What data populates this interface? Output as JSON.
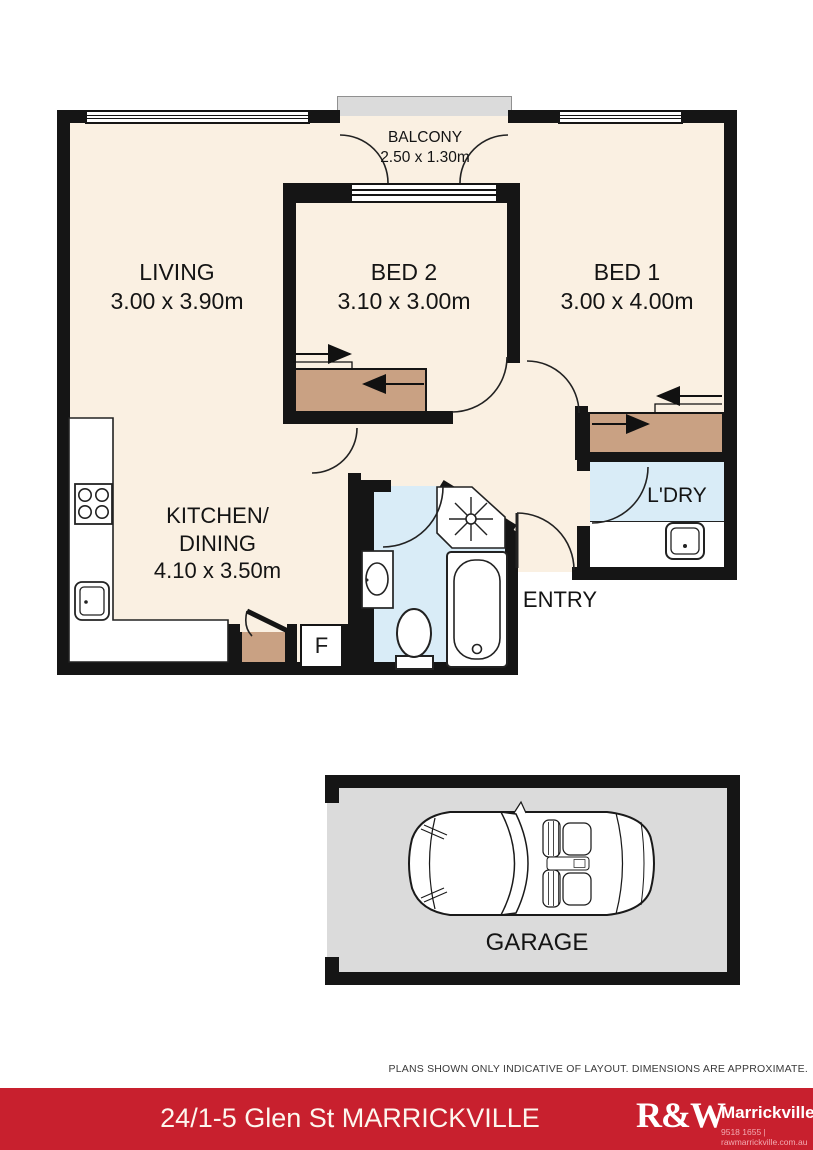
{
  "page": {
    "disclaimer": "PLANS SHOWN ONLY INDICATIVE OF LAYOUT. DIMENSIONS ARE APPROXIMATE.",
    "footer": {
      "address": "24/1-5 Glen St MARRICKVILLE",
      "brand": "R&W",
      "office": "Marrickville",
      "contact": "9518 1655 | rawmarrickville.com.au"
    }
  },
  "rooms": {
    "balcony": {
      "name": "BALCONY",
      "dims": "2.50 x 1.30m"
    },
    "living": {
      "name": "LIVING",
      "dims": "3.00 x 3.90m"
    },
    "bed2": {
      "name": "BED 2",
      "dims": "3.10 x 3.00m"
    },
    "bed1": {
      "name": "BED 1",
      "dims": "3.00 x 4.00m"
    },
    "kitchen": {
      "name_line1": "KITCHEN/",
      "name_line2": "DINING",
      "dims": "4.10 x 3.50m"
    },
    "laundry": {
      "name": "L'DRY"
    },
    "entry": {
      "name": "ENTRY"
    },
    "garage": {
      "name": "GARAGE"
    },
    "fridge": {
      "label": "F"
    }
  },
  "colors": {
    "wall": "#151515",
    "floor_cream": "#FAF0E2",
    "wet_blue": "#D9ECF7",
    "outdoor_grey": "#DBDBDB",
    "storage_tan": "#C9A183",
    "footer_red": "#C8202E"
  }
}
